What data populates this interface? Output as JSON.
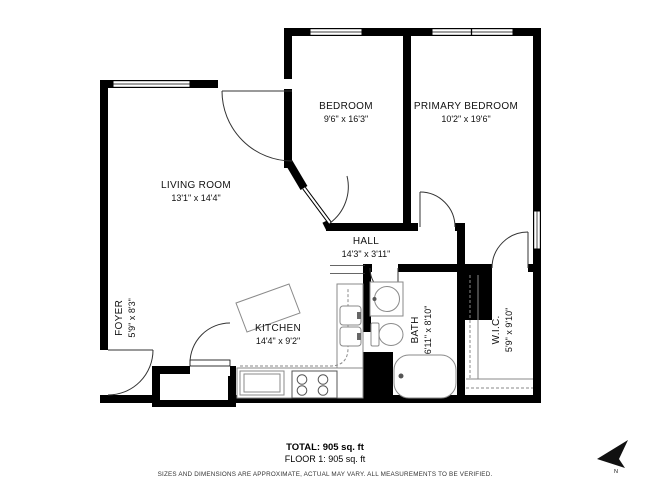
{
  "floor_plan": {
    "rooms": [
      {
        "name": "BEDROOM",
        "dimensions": "9'6\" x 16'3\""
      },
      {
        "name": "PRIMARY BEDROOM",
        "dimensions": "10'2\" x 19'6\""
      },
      {
        "name": "LIVING ROOM",
        "dimensions": "13'1\" x 14'4\""
      },
      {
        "name": "HALL",
        "dimensions": "14'3\" x 3'11\""
      },
      {
        "name": "KITCHEN",
        "dimensions": "14'4\" x 9'2\""
      },
      {
        "name": "FOYER",
        "dimensions": "5'9\" x 8'3\""
      },
      {
        "name": "BATH",
        "dimensions": "6'11\" x 8'10\""
      },
      {
        "name": "W.I.C.",
        "dimensions": "5'9\" x 9'10\""
      }
    ],
    "summary": {
      "total": "TOTAL: 905 sq. ft",
      "floor": "FLOOR 1: 905 sq. ft"
    },
    "disclaimer": "SIZES AND DIMENSIONS ARE APPROXIMATE, ACTUAL MAY VARY. ALL MEASUREMENTS TO BE VERIFIED.",
    "compass": {
      "label": "N"
    },
    "colors": {
      "wall": "#000000",
      "fixture_stroke": "#8a8a8a",
      "background": "#ffffff"
    }
  }
}
